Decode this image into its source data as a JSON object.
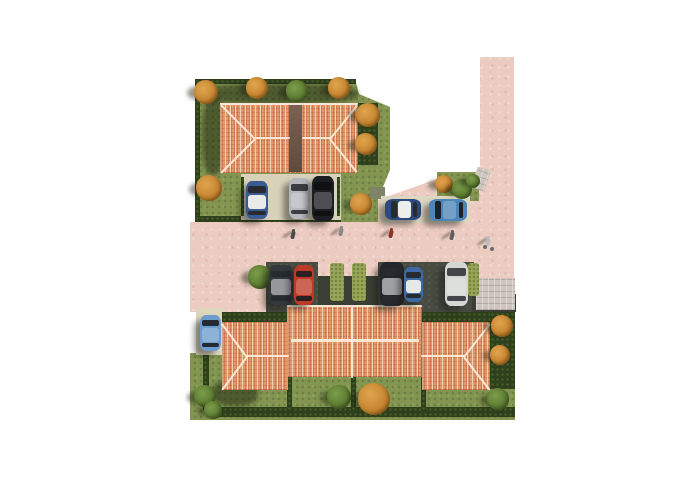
{
  "meta": {
    "title": "Aerial 3D site-plan rendering of a residential development",
    "description": "Top-down architectural visualization: two terracotta hip-roof buildings on green plots, L-shaped pink road, parking bays with cars, hedges, autumn trees and pedestrians",
    "car_count": 11,
    "pedestrian_count": 5
  },
  "scene": {
    "canvas": {
      "w": 700,
      "h": 495,
      "background": "#ffffff"
    },
    "palette": {
      "road": "#eccbc1",
      "grass": "#839551",
      "hedge": "#2e3f1c",
      "olive": "#9aa758",
      "roof": "#e2996d",
      "roof_stripe": "#cf7040",
      "roof_cream": "#f5ddc1",
      "ridge": "#fbeedd",
      "valley": "#6d5646",
      "asphalt": "#474b42",
      "pad_beige": "#d8d2ba",
      "paver": "#cdc5be",
      "shadow": "rgba(24,30,12,0.5)"
    },
    "tree_kinds": {
      "orange": [
        "#e0a54e",
        "#c07c28",
        "#8a5312"
      ],
      "green": [
        "#7d9c4a",
        "#53742c",
        "#33511a"
      ]
    },
    "layers": [
      {
        "t": "clip",
        "name": "road-main",
        "cls": "road",
        "pts": [
          [
            190,
            222
          ],
          [
            377,
            222
          ],
          [
            377,
            200
          ],
          [
            446,
            176
          ],
          [
            480,
            171
          ],
          [
            480,
            57
          ],
          [
            514,
            57
          ],
          [
            514,
            312
          ],
          [
            190,
            312
          ]
        ]
      },
      {
        "t": "clip",
        "name": "plot-top-left",
        "cls": "grass",
        "pts": [
          [
            195,
            79
          ],
          [
            355,
            79
          ],
          [
            359,
            94
          ],
          [
            390,
            107
          ],
          [
            390,
            170
          ],
          [
            378,
            199
          ],
          [
            378,
            222
          ],
          [
            195,
            222
          ]
        ]
      },
      {
        "t": "clip",
        "name": "plot-bottom",
        "cls": "grass",
        "pts": [
          [
            218,
            312
          ],
          [
            515,
            312
          ],
          [
            515,
            420
          ],
          [
            190,
            420
          ],
          [
            190,
            353
          ],
          [
            218,
            353
          ]
        ]
      },
      {
        "t": "rect",
        "name": "corner-green-strip",
        "cls": "grass",
        "x": 437,
        "y": 172,
        "w": 42,
        "h": 29
      },
      {
        "t": "rect",
        "name": "shaded-grass-patch",
        "x": 370,
        "y": 187,
        "w": 15,
        "h": 12,
        "bg": "#7e8468"
      },
      {
        "t": "rect",
        "name": "sidewalk-wedge",
        "cls": "paver",
        "x": 474,
        "y": 168,
        "w": 14,
        "h": 22,
        "rot": 18
      },
      {
        "t": "rect",
        "name": "hedge-top-north",
        "cls": "hedge",
        "x": 195,
        "y": 79,
        "w": 161,
        "h": 5
      },
      {
        "t": "rect",
        "name": "hedge-top-west",
        "cls": "hedge",
        "x": 195,
        "y": 79,
        "w": 5,
        "h": 143
      },
      {
        "t": "rect",
        "name": "hedge-top-east-band",
        "cls": "hedge",
        "x": 357,
        "y": 103,
        "w": 21,
        "h": 62
      },
      {
        "t": "rect",
        "name": "hedge-below-parking",
        "cls": "hedge",
        "x": 242,
        "y": 215,
        "w": 99,
        "h": 7
      },
      {
        "t": "rect",
        "name": "hedge-plot-top-southwest",
        "cls": "hedge",
        "x": 195,
        "y": 216,
        "w": 47,
        "h": 6
      },
      {
        "t": "rect",
        "name": "parking-pad-north",
        "cls": "pad",
        "x": 241,
        "y": 174,
        "w": 100,
        "h": 46,
        "bg": "#d8d2ba"
      },
      {
        "t": "rect",
        "name": "parking-post-left",
        "cls": "hedge",
        "x": 241,
        "y": 177,
        "w": 3,
        "h": 39
      },
      {
        "t": "rect",
        "name": "parking-post-right",
        "cls": "hedge",
        "x": 337,
        "y": 177,
        "w": 3,
        "h": 39
      },
      {
        "t": "rect",
        "name": "parking-pad-roadside",
        "cls": "pad",
        "x": 381,
        "y": 196,
        "w": 89,
        "h": 27,
        "bg": "#ddd7c1"
      },
      {
        "t": "rect",
        "name": "parking-pad-bottom-left",
        "cls": "pad",
        "x": 196,
        "y": 308,
        "w": 29,
        "h": 47,
        "bg": "#ded5bd"
      },
      {
        "t": "rect",
        "name": "driveway-bay-1",
        "cls": "asphalt",
        "x": 266,
        "y": 262,
        "w": 52,
        "h": 50
      },
      {
        "t": "rect",
        "name": "driveway-center",
        "x": 318,
        "y": 276,
        "w": 62,
        "h": 36,
        "bg": "#3a3e35"
      },
      {
        "t": "rect",
        "name": "driveway-bay-2",
        "cls": "asphalt",
        "x": 378,
        "y": 262,
        "w": 56,
        "h": 50
      },
      {
        "t": "rect",
        "name": "driveway-bay-3",
        "cls": "asphalt",
        "x": 434,
        "y": 262,
        "w": 40,
        "h": 50
      },
      {
        "t": "rect",
        "name": "driveway-east",
        "x": 472,
        "y": 294,
        "w": 44,
        "h": 18,
        "bg": "#3a3e35"
      },
      {
        "t": "rect",
        "name": "paver-entry-pad",
        "cls": "paver",
        "x": 476,
        "y": 278,
        "w": 39,
        "h": 32
      },
      {
        "t": "rect",
        "name": "hedge-bay-divider-1",
        "cls": "olive",
        "x": 330,
        "y": 263,
        "w": 14,
        "h": 38
      },
      {
        "t": "rect",
        "name": "hedge-bay-divider-2",
        "cls": "olive",
        "x": 352,
        "y": 263,
        "w": 14,
        "h": 38
      },
      {
        "t": "rect",
        "name": "hedge-bay-divider-3",
        "cls": "olive",
        "x": 468,
        "y": 263,
        "w": 11,
        "h": 33
      },
      {
        "t": "rect",
        "name": "hedge-bottom-west-inner",
        "cls": "hedge",
        "x": 203,
        "y": 355,
        "w": 6,
        "h": 55
      },
      {
        "t": "rect",
        "name": "hedge-bottom-south",
        "cls": "hedge",
        "x": 218,
        "y": 407,
        "w": 297,
        "h": 10
      },
      {
        "t": "rect",
        "name": "hedge-bottom-east",
        "cls": "hedge",
        "x": 490,
        "y": 312,
        "w": 25,
        "h": 77
      },
      {
        "t": "rect",
        "name": "hedge-north-of-left-wing",
        "cls": "hedge",
        "x": 222,
        "y": 312,
        "w": 66,
        "h": 13
      },
      {
        "t": "rect",
        "name": "hedge-north-of-right-wing",
        "cls": "hedge",
        "x": 422,
        "y": 312,
        "w": 68,
        "h": 13
      },
      {
        "t": "rect",
        "name": "garden-hedge-1",
        "cls": "hedge",
        "x": 287,
        "y": 376,
        "w": 5,
        "h": 36
      },
      {
        "t": "rect",
        "name": "garden-hedge-2",
        "cls": "hedge",
        "x": 351,
        "y": 376,
        "w": 5,
        "h": 36
      },
      {
        "t": "rect",
        "name": "garden-hedge-3",
        "cls": "hedge",
        "x": 421,
        "y": 376,
        "w": 5,
        "h": 36
      },
      {
        "t": "rect",
        "name": "building-shadow-top-north",
        "cls": "shade",
        "x": 200,
        "y": 84,
        "w": 158,
        "h": 20
      },
      {
        "t": "rect",
        "name": "building-shadow-top-west",
        "cls": "shade",
        "x": 202,
        "y": 97,
        "w": 22,
        "h": 78
      },
      {
        "t": "rect",
        "name": "building-shadow-bottom-lawn",
        "cls": "shade",
        "x": 212,
        "y": 380,
        "w": 46,
        "h": 26
      },
      {
        "t": "rect",
        "name": "building-top-roof",
        "cls": "roof",
        "x": 220,
        "y": 103,
        "w": 138,
        "h": 70
      },
      {
        "t": "rect",
        "name": "building-top-roof-valley",
        "cls": "valley",
        "x": 289,
        "y": 104,
        "w": 13,
        "h": 68
      },
      {
        "t": "rect",
        "name": "building-bottom-center-roof",
        "cls": "roof",
        "x": 287,
        "y": 305,
        "w": 135,
        "h": 72
      },
      {
        "t": "rect",
        "name": "building-bottom-left-wing-roof",
        "cls": "roof",
        "x": 222,
        "y": 322,
        "w": 66,
        "h": 68
      },
      {
        "t": "rect",
        "name": "building-bottom-right-wing-roof",
        "cls": "roof",
        "x": 422,
        "y": 322,
        "w": 68,
        "h": 68
      },
      {
        "t": "line",
        "name": "ridge-top-eave",
        "x": 220,
        "y": 103,
        "len": 138,
        "ang": 0,
        "th": 2
      },
      {
        "t": "line",
        "name": "ridge-top-hip-nw",
        "x": 221,
        "y": 104,
        "len": 48,
        "ang": 45
      },
      {
        "t": "line",
        "name": "ridge-top-hip-sw",
        "x": 221,
        "y": 172,
        "len": 48,
        "ang": -45
      },
      {
        "t": "line",
        "name": "ridge-top-left",
        "x": 255,
        "y": 137,
        "len": 35,
        "ang": 0
      },
      {
        "t": "line",
        "name": "ridge-top-right",
        "x": 302,
        "y": 137,
        "len": 29,
        "ang": 0
      },
      {
        "t": "line",
        "name": "ridge-top-hip-ne",
        "x": 330,
        "y": 138,
        "len": 43,
        "ang": -51
      },
      {
        "t": "line",
        "name": "ridge-top-hip-se",
        "x": 330,
        "y": 138,
        "len": 43,
        "ang": 51
      },
      {
        "t": "line",
        "name": "ridge-center-eave",
        "x": 287,
        "y": 305,
        "len": 135,
        "ang": 0,
        "th": 1.5
      },
      {
        "t": "line",
        "name": "ridge-center-main",
        "x": 291,
        "y": 339,
        "len": 128,
        "ang": 0,
        "th": 2.5
      },
      {
        "t": "line",
        "name": "ridge-center-party-wall",
        "x": 352,
        "y": 306,
        "len": 71,
        "ang": 90,
        "th": 2
      },
      {
        "t": "line",
        "name": "ridge-left-wing-hip-n",
        "x": 222,
        "y": 323,
        "len": 42,
        "ang": 53
      },
      {
        "t": "line",
        "name": "ridge-left-wing-hip-s",
        "x": 222,
        "y": 389,
        "len": 42,
        "ang": -53
      },
      {
        "t": "line",
        "name": "ridge-left-wing-main",
        "x": 246,
        "y": 355,
        "len": 43,
        "ang": 0,
        "th": 2
      },
      {
        "t": "line",
        "name": "ridge-right-wing-hip-n",
        "x": 464,
        "y": 356,
        "len": 42,
        "ang": -52
      },
      {
        "t": "line",
        "name": "ridge-right-wing-hip-s",
        "x": 464,
        "y": 356,
        "len": 42,
        "ang": 52
      },
      {
        "t": "line",
        "name": "ridge-right-wing-main",
        "x": 421,
        "y": 355,
        "len": 44,
        "ang": 0,
        "th": 2
      },
      {
        "t": "tree",
        "name": "tree-orange-1",
        "cx": 206,
        "cy": 92,
        "r": 12,
        "kind": "orange"
      },
      {
        "t": "tree",
        "name": "tree-orange-2",
        "cx": 257,
        "cy": 88,
        "r": 11,
        "kind": "orange"
      },
      {
        "t": "tree",
        "name": "tree-green-1",
        "cx": 297,
        "cy": 91,
        "r": 11,
        "kind": "green"
      },
      {
        "t": "tree",
        "name": "tree-orange-3",
        "cx": 339,
        "cy": 88,
        "r": 11,
        "kind": "orange"
      },
      {
        "t": "tree",
        "name": "tree-orange-4",
        "cx": 368,
        "cy": 115,
        "r": 12,
        "kind": "orange"
      },
      {
        "t": "tree",
        "name": "tree-orange-5",
        "cx": 366,
        "cy": 144,
        "r": 11,
        "kind": "orange"
      },
      {
        "t": "tree",
        "name": "tree-orange-6",
        "cx": 209,
        "cy": 188,
        "r": 13,
        "kind": "orange"
      },
      {
        "t": "tree",
        "name": "tree-orange-7",
        "cx": 361,
        "cy": 204,
        "r": 11,
        "kind": "orange"
      },
      {
        "t": "tree",
        "name": "tree-orange-8",
        "cx": 444,
        "cy": 184,
        "r": 9,
        "kind": "orange"
      },
      {
        "t": "tree",
        "name": "bush-green-1",
        "cx": 462,
        "cy": 189,
        "r": 10,
        "kind": "green"
      },
      {
        "t": "tree",
        "name": "bush-green-2",
        "cx": 473,
        "cy": 181,
        "r": 7,
        "kind": "green"
      },
      {
        "t": "tree",
        "name": "bush-green-3",
        "cx": 260,
        "cy": 277,
        "r": 12,
        "kind": "green"
      },
      {
        "t": "tree",
        "name": "bush-green-4",
        "cx": 205,
        "cy": 396,
        "r": 11,
        "kind": "green"
      },
      {
        "t": "tree",
        "name": "bush-green-5",
        "cx": 213,
        "cy": 410,
        "r": 9,
        "kind": "green"
      },
      {
        "t": "tree",
        "name": "bush-green-6",
        "cx": 339,
        "cy": 397,
        "r": 12,
        "kind": "green"
      },
      {
        "t": "tree",
        "name": "tree-orange-9",
        "cx": 374,
        "cy": 399,
        "r": 16,
        "kind": "orange"
      },
      {
        "t": "tree",
        "name": "tree-orange-10",
        "cx": 502,
        "cy": 326,
        "r": 11,
        "kind": "orange"
      },
      {
        "t": "tree",
        "name": "tree-orange-11",
        "cx": 500,
        "cy": 355,
        "r": 10,
        "kind": "orange"
      },
      {
        "t": "tree",
        "name": "bush-green-7",
        "cx": 498,
        "cy": 399,
        "r": 11,
        "kind": "green"
      },
      {
        "t": "car",
        "name": "car-row1-blue-white-top",
        "x": 246,
        "y": 181,
        "w": 22,
        "h": 38,
        "dir": "v",
        "body": "#3a5a92",
        "top": "#e9ebe8"
      },
      {
        "t": "car",
        "name": "car-row1-silver",
        "x": 289,
        "y": 178,
        "w": 21,
        "h": 41,
        "dir": "v",
        "body": "#b4b8bd",
        "glass": "#3a3e42"
      },
      {
        "t": "car",
        "name": "car-row1-black",
        "x": 312,
        "y": 176,
        "w": 22,
        "h": 45,
        "dir": "v",
        "body": "#1b1e22",
        "glass": "#0e1012",
        "trim": true
      },
      {
        "t": "car",
        "name": "car-roadside-darkblue-white-top",
        "x": 385,
        "y": 199,
        "w": 36,
        "h": 21,
        "dir": "h",
        "body": "#2c4a7e",
        "top": "#eceeeb"
      },
      {
        "t": "car",
        "name": "car-roadside-steelblue",
        "x": 429,
        "y": 199,
        "w": 38,
        "h": 22,
        "dir": "h",
        "body": "#4d85b8",
        "glass": "#1d2226"
      },
      {
        "t": "car",
        "name": "car-row2-dark-suv",
        "x": 269,
        "y": 265,
        "w": 24,
        "h": 40,
        "dir": "v",
        "body": "#33383b",
        "top": "#96999b"
      },
      {
        "t": "car",
        "name": "car-row2-red",
        "x": 294,
        "y": 265,
        "w": 20,
        "h": 40,
        "dir": "v",
        "body": "#bd3a26",
        "glass": "#2a1f21"
      },
      {
        "t": "car",
        "name": "car-row2-black",
        "x": 380,
        "y": 262,
        "w": 24,
        "h": 44,
        "dir": "v",
        "body": "#24272b",
        "top": "#9da1a3"
      },
      {
        "t": "car",
        "name": "car-row2-blue-white-top",
        "x": 404,
        "y": 267,
        "w": 19,
        "h": 35,
        "dir": "v",
        "body": "#3d6aa4",
        "top": "#e7e9e7"
      },
      {
        "t": "car",
        "name": "car-row2-white",
        "x": 445,
        "y": 262,
        "w": 23,
        "h": 44,
        "dir": "v",
        "body": "#d3d6d3",
        "glass": "#41464a"
      },
      {
        "t": "car",
        "name": "car-bottom-lightblue",
        "x": 200,
        "y": 315,
        "w": 21,
        "h": 36,
        "dir": "v",
        "body": "#6d9dce",
        "glass": "#232a31"
      },
      {
        "t": "person",
        "name": "pedestrian-1",
        "x": 291,
        "y": 235,
        "color": "#4a4a4a"
      },
      {
        "t": "person",
        "name": "pedestrian-2",
        "x": 339,
        "y": 232,
        "color": "#8a8a8a"
      },
      {
        "t": "person",
        "name": "pedestrian-3",
        "x": 389,
        "y": 234,
        "color": "#8c3127"
      },
      {
        "t": "person",
        "name": "pedestrian-4",
        "x": 450,
        "y": 236,
        "color": "#5f5f5f"
      },
      {
        "t": "person",
        "name": "cyclist-1",
        "x": 486,
        "y": 242,
        "color": "#b9bdc0",
        "bike": true
      }
    ]
  }
}
